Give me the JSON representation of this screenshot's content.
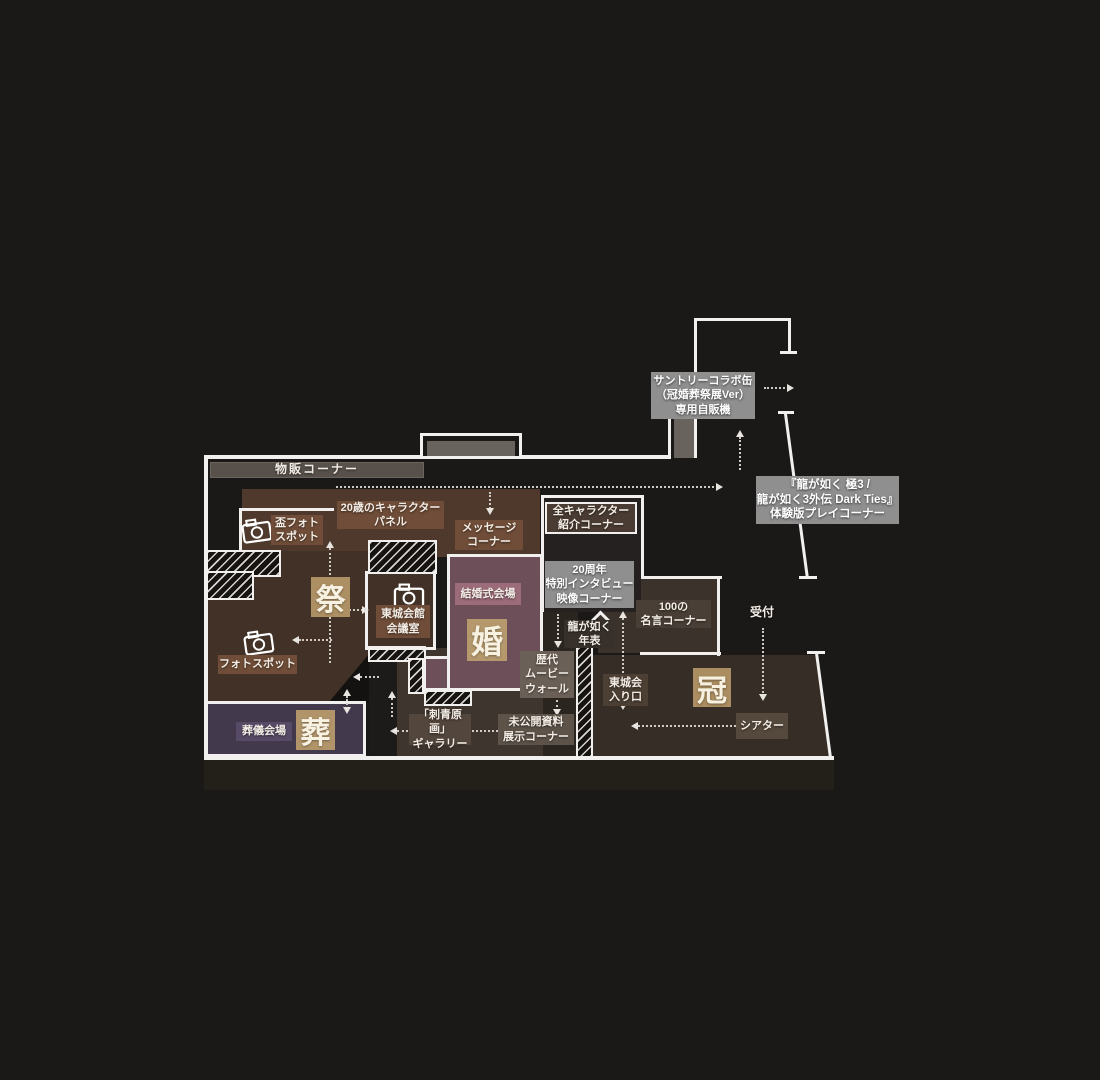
{
  "palette": {
    "background": "#1a1918",
    "wall_white": "#f2f0ee",
    "room_brown_light": "#4e392c",
    "room_brown": "#413127",
    "room_brown_dark": "#362e26",
    "room_tattoo": "#3e362e",
    "room_mauve": "#6d4f59",
    "room_purple": "#43394d",
    "label_brown": "#6f4d38",
    "label_gray": "#8f8f8f",
    "gold_box": "#ac8f62",
    "wedding_label": "#9d6c7b",
    "funeral_label": "#574a66",
    "merch_bar": "#58514b",
    "dotted_arrow": "#cfcac4"
  },
  "map": {
    "merch_bar": "物販コーナー",
    "suntory_vending": "サントリーコラボ缶\n（冠婚葬祭展Ver）\n専用自販機",
    "demo_corner": "『龍が如く 極3 /\n龍が如く3外伝 Dark Ties』\n体験版プレイコーナー",
    "panel_20th": "20歳のキャラクター\nパネル",
    "sakazuki_photo": "盃フォト\nスポット",
    "message_corner": "メッセージ\nコーナー",
    "all_characters": "全キャラクター\n紹介コーナー",
    "interview_20th": "20周年\n特別インタビュー\n映像コーナー",
    "meigen_100": "100の\n名言コーナー",
    "reception": "受付",
    "zone_festival": "祭",
    "tojo_meeting_room": "東城会館\n会議室",
    "wedding_hall": "結婚式会場",
    "zone_wedding": "婚",
    "timeline": "龍が如く\n年表",
    "tojo_entrance": "東城会\n入り口",
    "zone_coronation": "冠",
    "photo_spot": "フォトスポット",
    "movie_wall": "歴代\nムービー\nウォール",
    "theater": "シアター",
    "funeral_hall": "葬儀会場",
    "zone_funeral": "葬",
    "tattoo_gallery": "「刺青原画」\nギャラリー",
    "unreleased_materials": "未公開資料\n展示コーナー"
  }
}
